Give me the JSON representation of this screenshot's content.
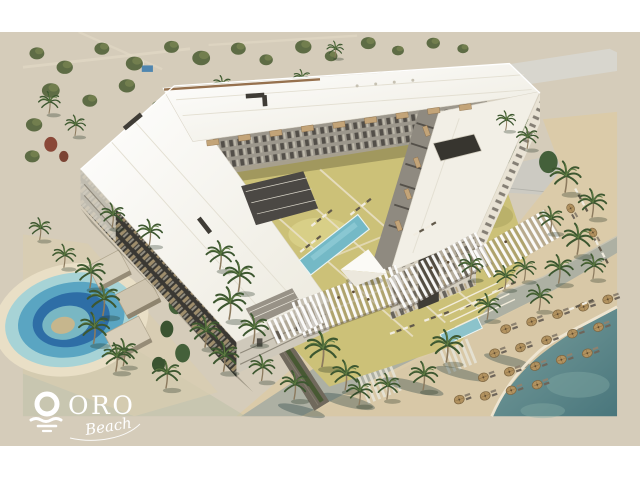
{
  "logo": {
    "wordmark": "ORO",
    "script": "Beach",
    "color": "#ffffff"
  },
  "icons": {
    "logo_mark": "sun-over-sea-waves-icon"
  },
  "palette": {
    "page_band": "#ffffff",
    "desert_sand": "#d5ccba",
    "beach_sand": "#d8c8a7",
    "sea_teal": "#5d8587",
    "lagoon_deep_blue": "#2e6ea6",
    "lagoon_turquoise": "#a7d3d6",
    "roof_white": "#f8f6ef",
    "facade_dark": "#3a3833",
    "facade_light": "#ddd7ca",
    "awning_tan": "#c3a478",
    "lawn_olive": "#ccc178",
    "pool_blue": "#74b9c6",
    "pergola_white": "#fbfaf6",
    "umbrella_straw": "#b2925f",
    "palm_green": "#3d5730",
    "ghost_building_gray": "#c9c9c3",
    "promenade_gray": "#adb0a3"
  }
}
